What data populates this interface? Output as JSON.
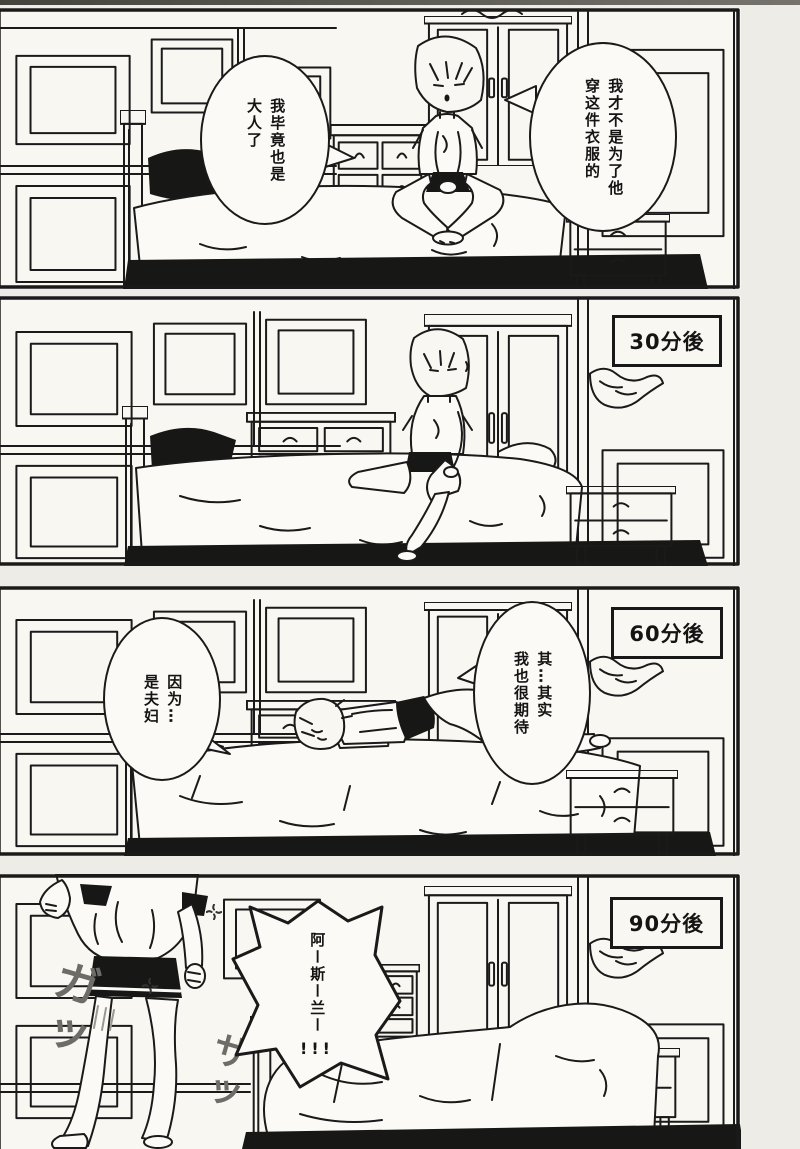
{
  "page": {
    "paper_color": "#edece6",
    "panel_bg": "#f8f7f2",
    "line_color": "#1a1a1a",
    "shadow_black": "#171715",
    "sfx_color": "#6e6c66"
  },
  "panel1": {
    "bubble_left": "我毕竟也是\n大人了",
    "bubble_right": "我才不是为了他\n穿这件衣服的"
  },
  "panel2": {
    "time_label": "30分後"
  },
  "panel3": {
    "time_label": "60分後",
    "bubble_left": "因为…\n是夫妇",
    "bubble_right": "其…其实\n我也很期待"
  },
  "panel4": {
    "time_label": "90分後",
    "shout": "阿ー斯ー兰ー",
    "shout_exclaim": "!!!",
    "sfx_left": "ガッ",
    "sfx_bed": "ザッ"
  }
}
